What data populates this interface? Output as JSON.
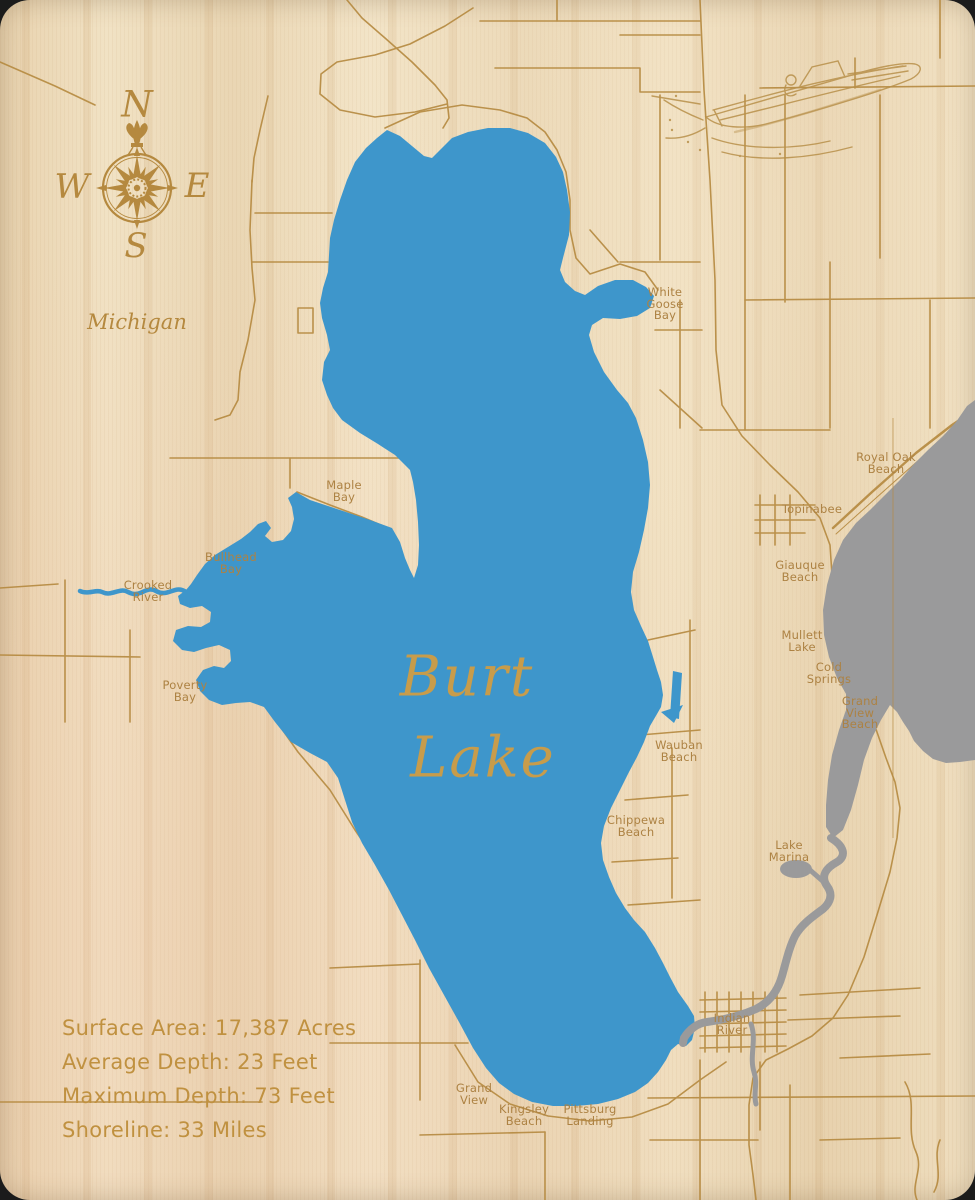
{
  "title": "Burt Lake wooden engraved map",
  "colors": {
    "lake_blue": "#3e96cb",
    "connected_water_gray": "#9a9a9b",
    "etch_tan": "#b5893f",
    "label_tan": "#ad8243",
    "lake_title_gold": "#c79c4b",
    "stats_gold": "#c09140",
    "wood_base": "#eddcbd"
  },
  "state_label": "Michigan",
  "lake_name": {
    "line1": "Burt",
    "line2": "Lake"
  },
  "compass": {
    "north": "N",
    "east": "E",
    "south": "S",
    "west": "W"
  },
  "stats": {
    "surface_area": "Surface Area: 17,387 Acres",
    "average_depth": "Average Depth: 23 Feet",
    "maximum_depth": "Maximum Depth: 73 Feet",
    "shoreline": "Shoreline: 33 Miles"
  },
  "place_labels": [
    {
      "id": "white-goose-bay",
      "lines": [
        "White",
        "Goose",
        "Bay"
      ],
      "x": 665,
      "y": 287
    },
    {
      "id": "maple-bay",
      "lines": [
        "Maple",
        "Bay"
      ],
      "x": 344,
      "y": 480
    },
    {
      "id": "bullhead-bay",
      "lines": [
        "Bullhead",
        "Bay"
      ],
      "x": 231,
      "y": 552
    },
    {
      "id": "crooked-river",
      "lines": [
        "Crooked",
        "River"
      ],
      "x": 148,
      "y": 580
    },
    {
      "id": "poverty-bay",
      "lines": [
        "Poverty",
        "Bay"
      ],
      "x": 185,
      "y": 680
    },
    {
      "id": "royal-oak-beach",
      "lines": [
        "Royal Oak",
        "Beach"
      ],
      "x": 886,
      "y": 452
    },
    {
      "id": "topinabee",
      "lines": [
        "Topinabee"
      ],
      "x": 812,
      "y": 504
    },
    {
      "id": "giauque-beach",
      "lines": [
        "Giauque",
        "Beach"
      ],
      "x": 800,
      "y": 560
    },
    {
      "id": "mullett-lake",
      "lines": [
        "Mullett",
        "Lake"
      ],
      "x": 802,
      "y": 630
    },
    {
      "id": "cold-springs",
      "lines": [
        "Cold",
        "Springs"
      ],
      "x": 829,
      "y": 662
    },
    {
      "id": "grand-view-beach",
      "lines": [
        "Grand",
        "View",
        "Beach"
      ],
      "x": 860,
      "y": 696
    },
    {
      "id": "wauban-beach",
      "lines": [
        "Wauban",
        "Beach"
      ],
      "x": 679,
      "y": 740
    },
    {
      "id": "chippewa-beach",
      "lines": [
        "Chippewa",
        "Beach"
      ],
      "x": 636,
      "y": 815
    },
    {
      "id": "lake-marina",
      "lines": [
        "Lake",
        "Marina"
      ],
      "x": 789,
      "y": 840
    },
    {
      "id": "indian-river",
      "lines": [
        "Indian",
        "River"
      ],
      "x": 732,
      "y": 1013
    },
    {
      "id": "grand-view",
      "lines": [
        "Grand",
        "View"
      ],
      "x": 474,
      "y": 1083
    },
    {
      "id": "kingsley-beach",
      "lines": [
        "Kingsley",
        "Beach"
      ],
      "x": 524,
      "y": 1104
    },
    {
      "id": "pittsburg-landing",
      "lines": [
        "Pittsburg",
        "Landing"
      ],
      "x": 590,
      "y": 1104
    }
  ]
}
